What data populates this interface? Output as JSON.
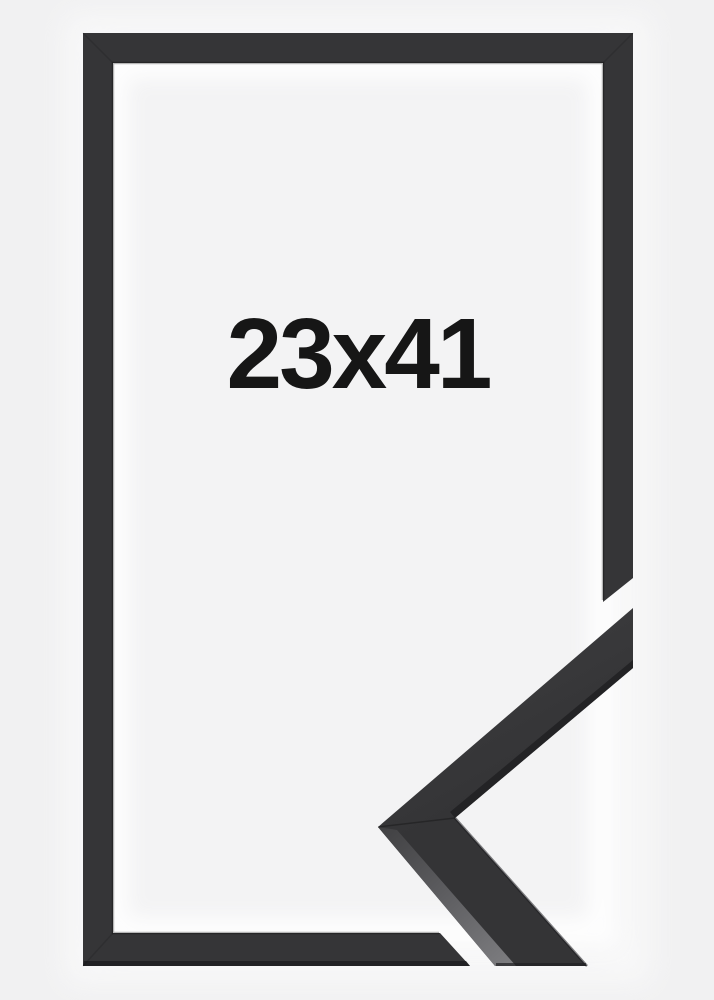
{
  "product": {
    "size_label": "23x41",
    "colors": {
      "background": "#f1f1f2",
      "inner_mat": "#f3f3f4",
      "frame": "#353537",
      "label_text": "#161616"
    }
  }
}
